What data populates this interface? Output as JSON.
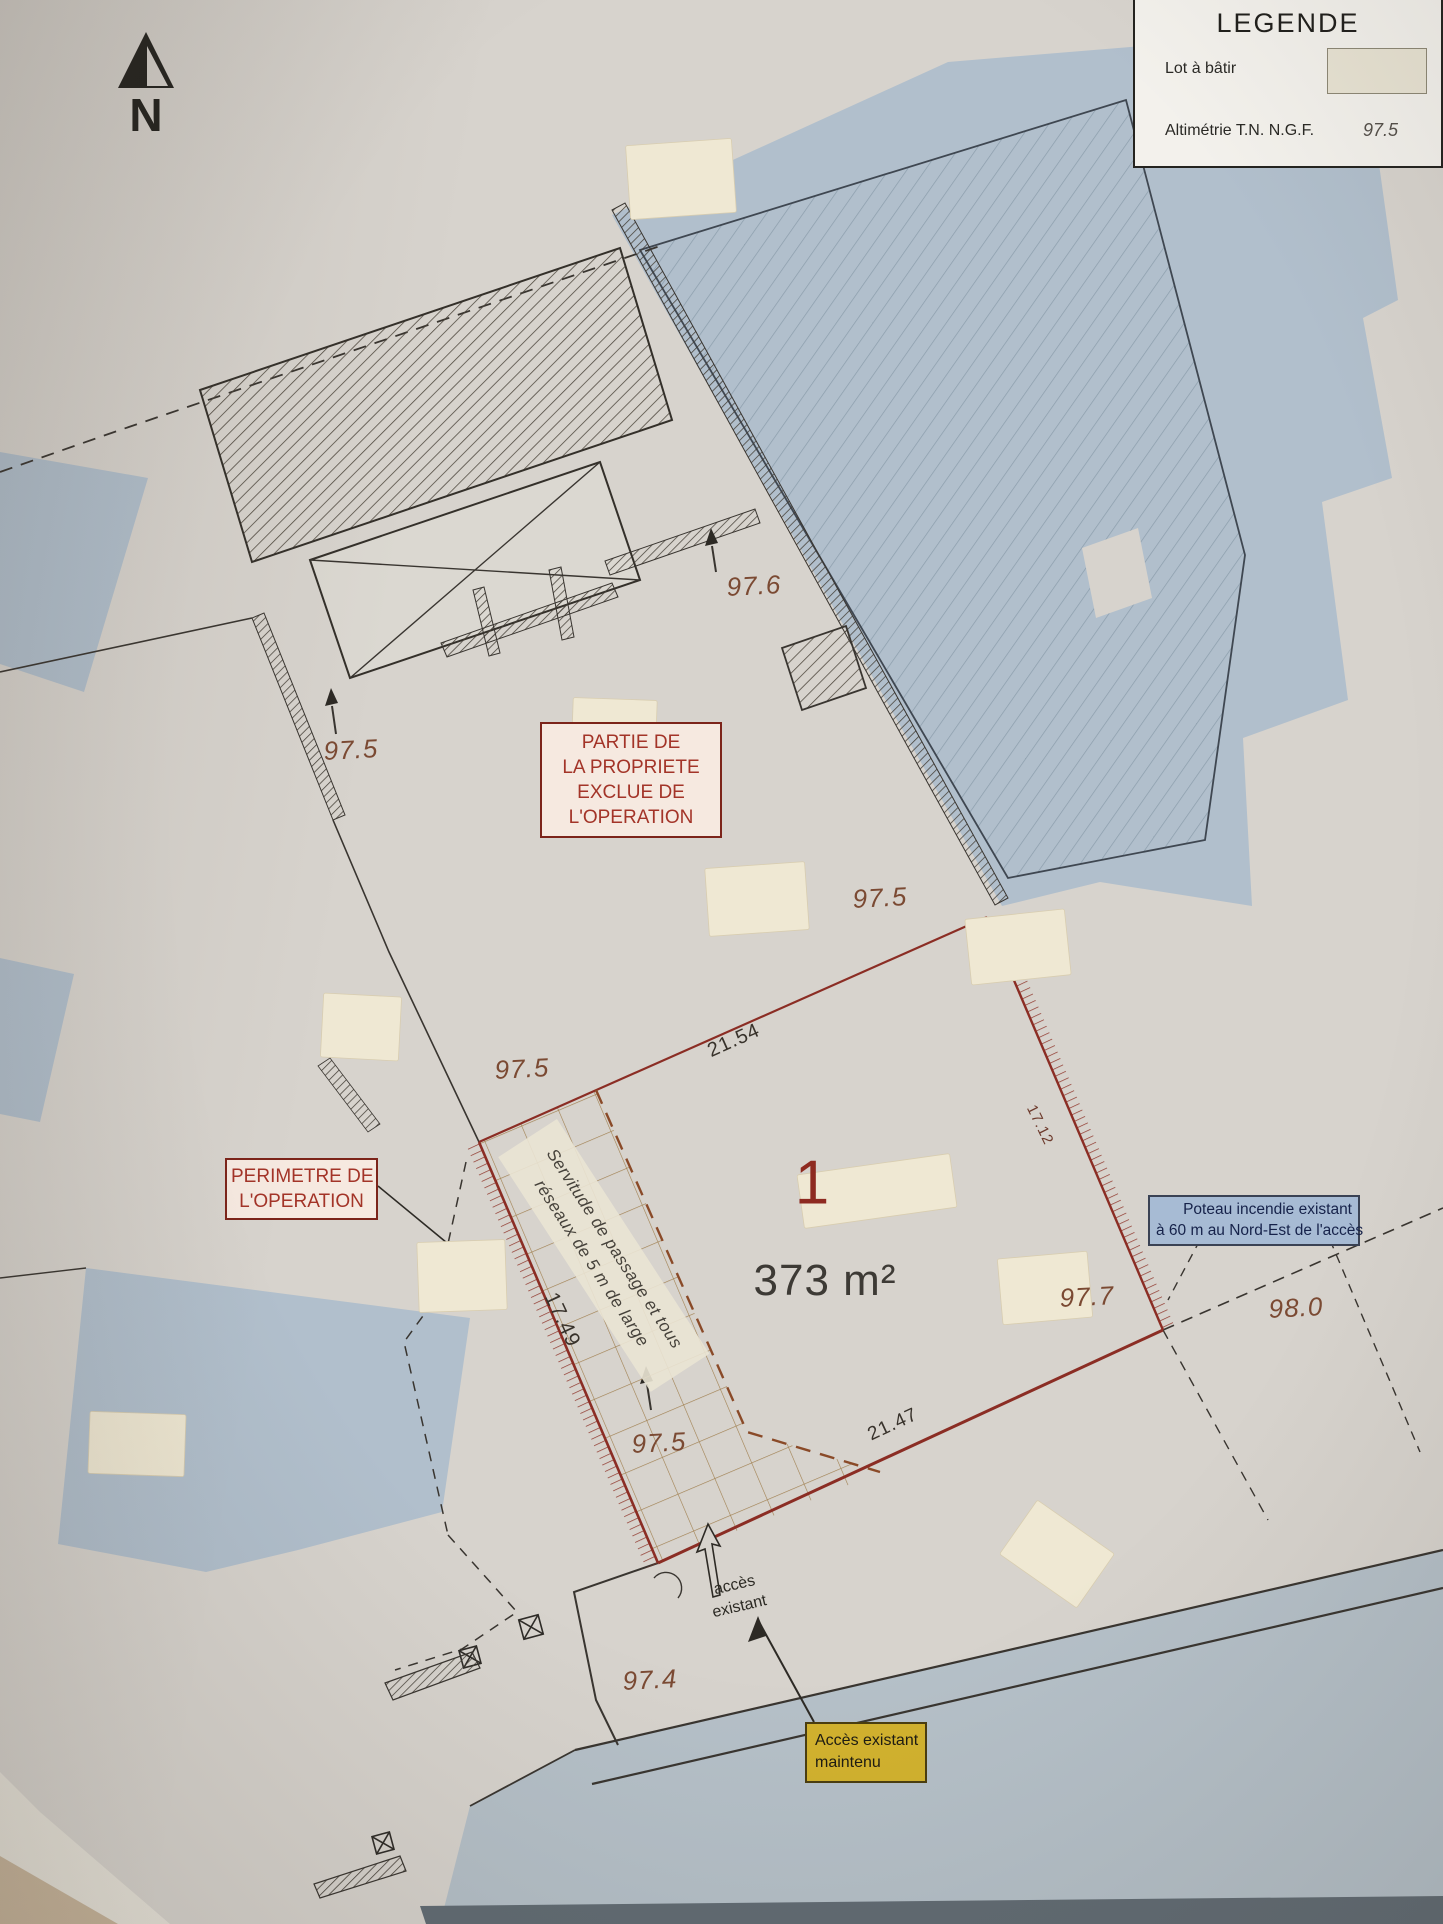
{
  "north": {
    "label": "N"
  },
  "legend": {
    "title": "LEGENDE",
    "lot_item_label": "Lot à bâtir",
    "swatch_color": "#e8e3d3",
    "alt_item_label": "Altimétrie T.N. N.G.F.",
    "alt_item_value": "97.5"
  },
  "lot": {
    "number": "1",
    "area_label": "373 m²"
  },
  "callouts": {
    "excluded": {
      "line1": "PARTIE DE",
      "line2": "LA PROPRIETE",
      "line3": "EXCLUE DE",
      "line4": "L'OPERATION"
    },
    "perimeter": {
      "line1": "PERIMETRE DE",
      "line2": "L'OPERATION"
    },
    "hydrant": {
      "line1": "Poteau incendie existant",
      "line2": "à 60 m au Nord-Est de l'accès"
    },
    "access": {
      "line1": "Accès existant",
      "line2": "maintenu"
    }
  },
  "dimensions": {
    "top_edge": "21.54",
    "bottom_edge": "21.47",
    "west_edge": "17.49",
    "east_edge": "17.12"
  },
  "elevations": {
    "e0": "97.6",
    "e1": "97.5",
    "e2": "97.5",
    "e3": "97.5",
    "e4": "97.5",
    "e5": "97.7",
    "e6": "98.0",
    "e7": "97.4"
  },
  "easement": {
    "line1": "Servitude de passage et tous",
    "line2": "réseaux de 5 m de large"
  },
  "access_label": {
    "line1": "accès",
    "line2": "existant"
  },
  "colors": {
    "lot_boundary": "#8b2d24",
    "building_fill": "#b1bfcc",
    "excluded_box_text": "#a33428",
    "hydrant_box_bg": "#a7bbd4",
    "access_box_bg": "#d2b22e",
    "easement_dash": "#8a4a28"
  }
}
